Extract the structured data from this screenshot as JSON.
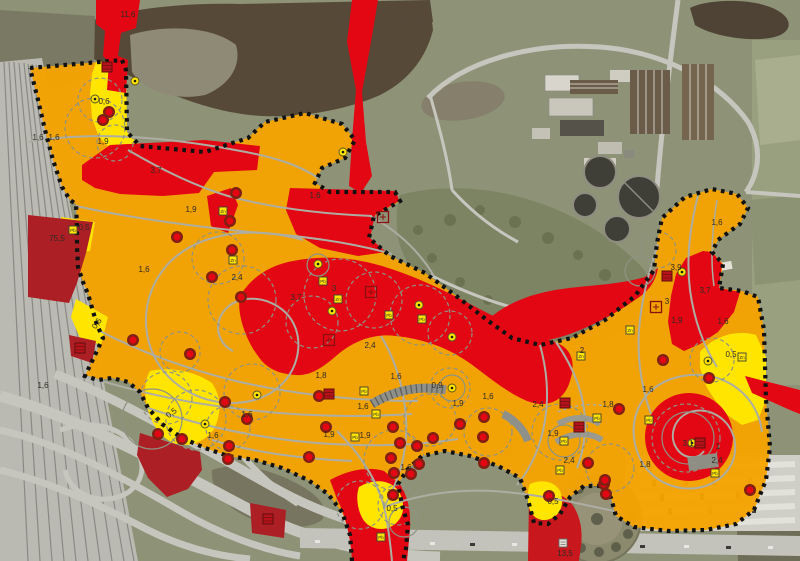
{
  "map": {
    "colors": {
      "zone_orange": "#F5A300",
      "zone_red": "#E30613",
      "zone_dark_red": "#AC1F24",
      "zone_yellow": "#FFE500",
      "boundary_dots": "#111111",
      "path_gray": "#ADADA3",
      "water": "#564938",
      "label_text": "#2E2B25"
    },
    "value_labels": [
      {
        "text": "11,6",
        "x": 128,
        "y": 17
      },
      {
        "text": "0,6",
        "x": 104,
        "y": 104
      },
      {
        "text": "1,6",
        "x": 38,
        "y": 140
      },
      {
        "text": "1,6",
        "x": 54,
        "y": 140
      },
      {
        "text": "1,9",
        "x": 103,
        "y": 144
      },
      {
        "text": "3,7",
        "x": 156,
        "y": 173
      },
      {
        "text": "75,5",
        "x": 57,
        "y": 241
      },
      {
        "text": "0,5",
        "x": 84,
        "y": 230
      },
      {
        "text": "1,9",
        "x": 191,
        "y": 212
      },
      {
        "text": "1,6",
        "x": 144,
        "y": 272
      },
      {
        "text": "2,4",
        "x": 237,
        "y": 280
      },
      {
        "text": "0,5",
        "x": 99,
        "y": 325,
        "rot": -55
      },
      {
        "text": "1,6",
        "x": 315,
        "y": 198
      },
      {
        "text": "3,7",
        "x": 296,
        "y": 300
      },
      {
        "text": "3",
        "x": 334,
        "y": 291
      },
      {
        "text": "2,4",
        "x": 370,
        "y": 348
      },
      {
        "text": "1,6",
        "x": 43,
        "y": 388
      },
      {
        "text": "0,5",
        "x": 173,
        "y": 415,
        "rot": -38
      },
      {
        "text": "1,6",
        "x": 213,
        "y": 438
      },
      {
        "text": "1,6",
        "x": 247,
        "y": 417
      },
      {
        "text": "1,8",
        "x": 321,
        "y": 378
      },
      {
        "text": "1,6",
        "x": 396,
        "y": 379
      },
      {
        "text": "0,9",
        "x": 437,
        "y": 388
      },
      {
        "text": "1,9",
        "x": 458,
        "y": 406
      },
      {
        "text": "1,6",
        "x": 488,
        "y": 399
      },
      {
        "text": "1,6",
        "x": 363,
        "y": 409
      },
      {
        "text": "1,9",
        "x": 329,
        "y": 437
      },
      {
        "text": "1,9",
        "x": 365,
        "y": 438
      },
      {
        "text": "1,6",
        "x": 406,
        "y": 470
      },
      {
        "text": "0,5",
        "x": 392,
        "y": 511
      },
      {
        "text": "1,6",
        "x": 717,
        "y": 225
      },
      {
        "text": "3,9",
        "x": 676,
        "y": 270
      },
      {
        "text": "3",
        "x": 667,
        "y": 304
      },
      {
        "text": "3,7",
        "x": 705,
        "y": 293
      },
      {
        "text": "1,9",
        "x": 677,
        "y": 323
      },
      {
        "text": "1,6",
        "x": 723,
        "y": 324
      },
      {
        "text": "0,5",
        "x": 731,
        "y": 357
      },
      {
        "text": "2",
        "x": 582,
        "y": 353
      },
      {
        "text": "2,4",
        "x": 538,
        "y": 407
      },
      {
        "text": "1,8",
        "x": 608,
        "y": 407
      },
      {
        "text": "1,6",
        "x": 648,
        "y": 392
      },
      {
        "text": "1,9",
        "x": 553,
        "y": 436
      },
      {
        "text": "2,4",
        "x": 569,
        "y": 463
      },
      {
        "text": "1,8",
        "x": 645,
        "y": 467
      },
      {
        "text": "0,5",
        "x": 553,
        "y": 504
      },
      {
        "text": "2,4",
        "x": 717,
        "y": 463
      },
      {
        "text": "1",
        "x": 718,
        "y": 449
      },
      {
        "text": "3,1",
        "x": 688,
        "y": 446
      },
      {
        "text": "13,5",
        "x": 565,
        "y": 556
      }
    ],
    "point_markers": {
      "tree_markers_red": [
        [
          109,
          112
        ],
        [
          103,
          120
        ],
        [
          236,
          193
        ],
        [
          230,
          221
        ],
        [
          177,
          237
        ],
        [
          232,
          250
        ],
        [
          212,
          277
        ],
        [
          241,
          297
        ],
        [
          133,
          340
        ],
        [
          190,
          354
        ],
        [
          319,
          396
        ],
        [
          326,
          427
        ],
        [
          309,
          457
        ],
        [
          225,
          402
        ],
        [
          247,
          419
        ],
        [
          229,
          446
        ],
        [
          228,
          459
        ],
        [
          158,
          434
        ],
        [
          182,
          439
        ],
        [
          393,
          427
        ],
        [
          400,
          443
        ],
        [
          417,
          446
        ],
        [
          391,
          458
        ],
        [
          419,
          464
        ],
        [
          394,
          473
        ],
        [
          411,
          474
        ],
        [
          393,
          495
        ],
        [
          460,
          424
        ],
        [
          433,
          438
        ],
        [
          484,
          417
        ],
        [
          483,
          437
        ],
        [
          484,
          463
        ],
        [
          549,
          496
        ],
        [
          604,
          484
        ],
        [
          606,
          494
        ],
        [
          619,
          409
        ],
        [
          588,
          463
        ],
        [
          605,
          480
        ],
        [
          663,
          360
        ],
        [
          709,
          378
        ],
        [
          750,
          490
        ]
      ],
      "sample_points_yellow": [
        [
          135,
          81
        ],
        [
          95,
          99
        ],
        [
          343,
          152
        ],
        [
          318,
          264
        ],
        [
          332,
          311
        ],
        [
          419,
          305
        ],
        [
          452,
          337
        ],
        [
          257,
          395
        ],
        [
          205,
          424
        ],
        [
          452,
          388
        ],
        [
          682,
          272
        ],
        [
          692,
          443
        ],
        [
          708,
          361
        ]
      ],
      "sample_squares_yellow": [
        {
          "x": 73,
          "y": 230,
          "sym": "Pb"
        },
        {
          "x": 223,
          "y": 211,
          "sym": "Zn"
        },
        {
          "x": 233,
          "y": 260,
          "sym": "Zn"
        },
        {
          "x": 323,
          "y": 281,
          "sym": "Pb"
        },
        {
          "x": 338,
          "y": 299,
          "sym": "Zn"
        },
        {
          "x": 389,
          "y": 315,
          "sym": "Pb"
        },
        {
          "x": 422,
          "y": 319,
          "sym": "Pb"
        },
        {
          "x": 364,
          "y": 391,
          "sym": "Pb"
        },
        {
          "x": 376,
          "y": 414,
          "sym": "Pb"
        },
        {
          "x": 355,
          "y": 437,
          "sym": "Pb"
        },
        {
          "x": 381,
          "y": 537,
          "sym": "Pb"
        },
        {
          "x": 581,
          "y": 356,
          "sym": "Zn"
        },
        {
          "x": 630,
          "y": 330,
          "sym": "Zn"
        },
        {
          "x": 742,
          "y": 357,
          "sym": "Zn"
        },
        {
          "x": 597,
          "y": 418,
          "sym": "Pb"
        },
        {
          "x": 649,
          "y": 420,
          "sym": "Pb"
        },
        {
          "x": 715,
          "y": 473,
          "sym": "Pb"
        },
        {
          "x": 564,
          "y": 441,
          "sym": "Pb"
        },
        {
          "x": 560,
          "y": 470,
          "sym": "Pb"
        }
      ],
      "feature_squares_red_filled": [
        [
          107,
          67
        ],
        [
          329,
          394
        ],
        [
          565,
          403
        ],
        [
          579,
          427
        ],
        [
          667,
          276
        ],
        [
          700,
          443
        ],
        [
          80,
          348
        ],
        [
          268,
          519
        ]
      ],
      "feature_squares_red_outline": [
        [
          383,
          217
        ],
        [
          371,
          292
        ],
        [
          656,
          307
        ],
        [
          329,
          340
        ]
      ],
      "feature_square_white": [
        [
          563,
          543
        ]
      ]
    }
  }
}
